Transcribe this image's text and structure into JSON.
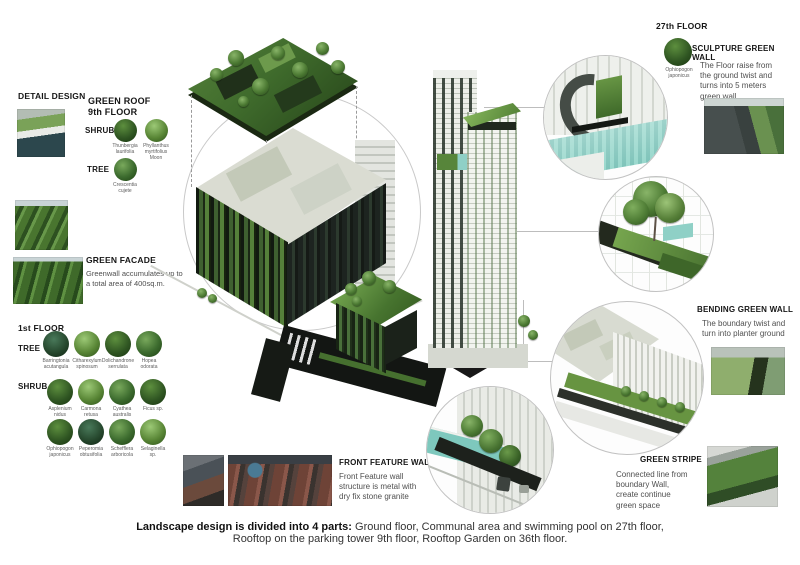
{
  "detail_design": {
    "title": "DETAIL DESIGN"
  },
  "green_roof": {
    "title": "GREEN ROOF",
    "subtitle": "9th FLOOR",
    "shrub_label": "SHRUB",
    "tree_label": "TREE",
    "shrubs": [
      "Thunbergia laurifolia",
      "Phyllanthus myrtifolius Moon"
    ],
    "tree": "Crescentia cujete"
  },
  "green_facade": {
    "title": "GREEN FACADE",
    "description": "Greenwall accumulates up to a total area of 400sq.m."
  },
  "first_floor": {
    "title": "1st FLOOR",
    "tree_label": "TREE",
    "shrub_label": "SHRUB",
    "trees": [
      "Barringtonia acutangula",
      "Citharexylum spinosum",
      "Dolichandrone serrulata",
      "Hopea odorata"
    ],
    "shrubs": [
      "Asplenium nidus",
      "Carmona retusa",
      "Cyathea australis",
      "Ficus sp.",
      "Ophiopogon japonicus",
      "Peperomia obtusifolia",
      "Schefflera arboricola",
      "Selaginella sp."
    ]
  },
  "floor27": {
    "title": "27th FLOOR",
    "plant": "Ophiopogon japonicus"
  },
  "sculpture_wall": {
    "title": "SCULPTURE GREEN WALL",
    "description": "The Floor raise from the ground twist and turns into 5 meters green wall"
  },
  "bending_wall": {
    "title": "BENDING GREEN WALL",
    "description": "The boundary twist and turn into planter ground"
  },
  "green_stripe": {
    "title": "GREEN STRIPE",
    "description": "Connected line from boundary Wall, create continue green space"
  },
  "front_feature_wall": {
    "title": "FRONT FEATURE WALL",
    "description": "Front Feature wall structure is metal with dry fix stone granite"
  },
  "caption": {
    "lead": "Landscape design is divided into 4 parts:",
    "line1": " Ground floor, Communal area and swimming pool on 27th floor,",
    "line2": "Rooftop on the parking tower 9th floor, Rooftop Garden on 36th floor."
  },
  "colors": {
    "foliage": "#47742f",
    "foliage_dark": "#22361a",
    "pool_teal": "#8fd0c6",
    "paving_black": "#131613"
  }
}
